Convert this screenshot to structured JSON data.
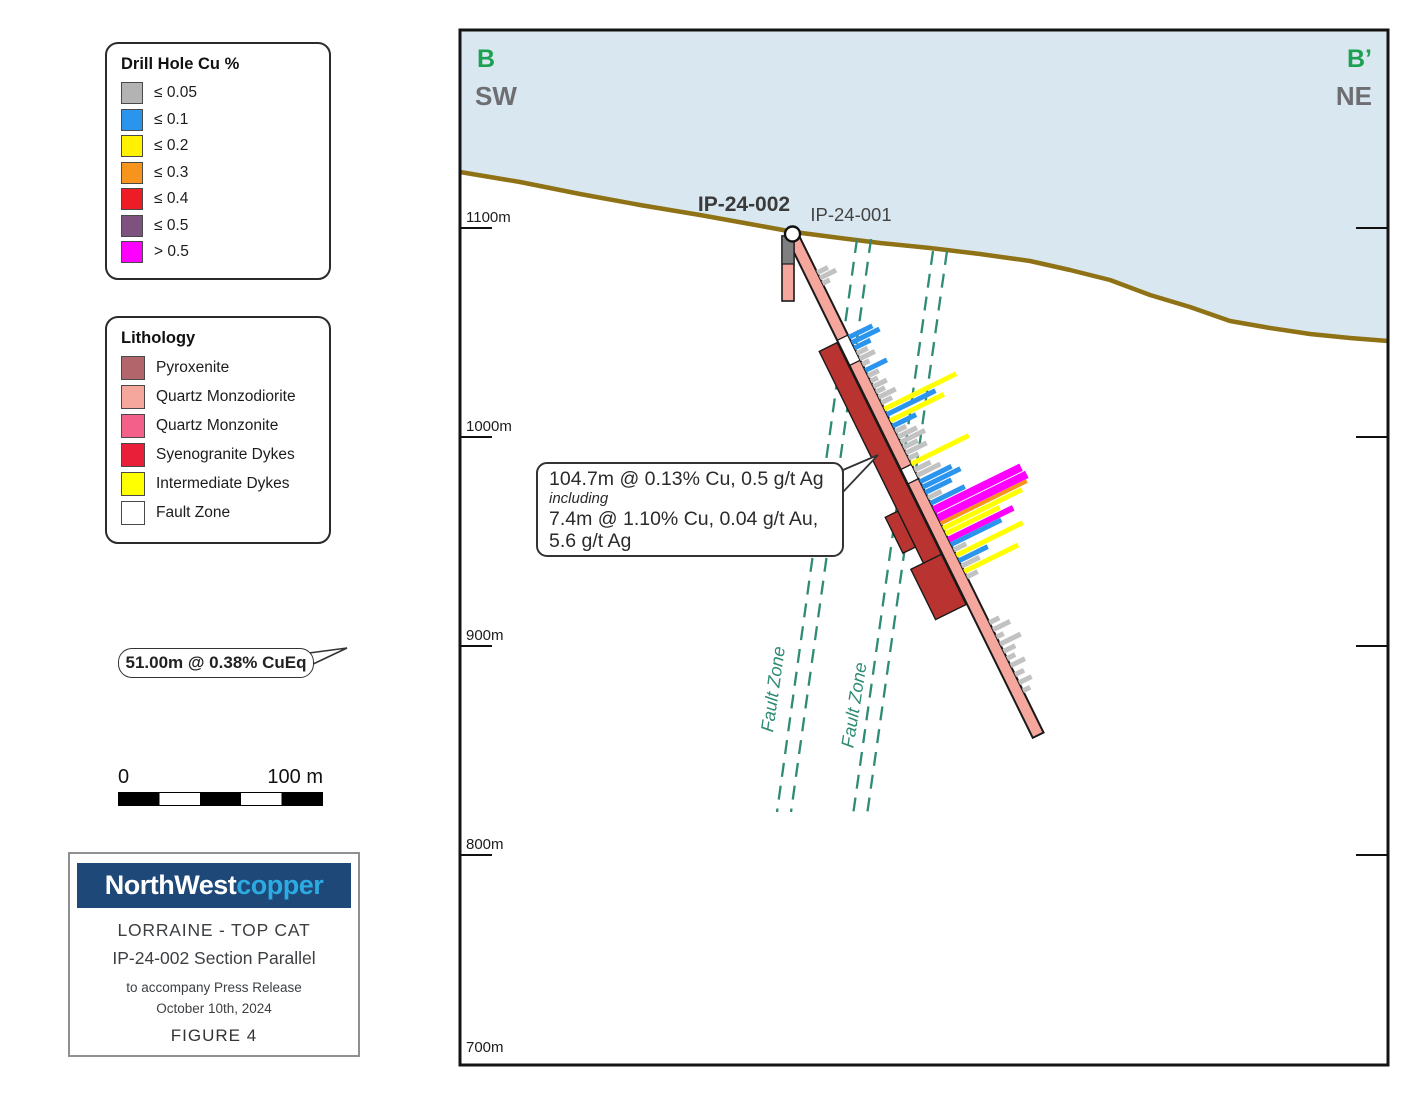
{
  "colors": {
    "sky": "#d9e8f0",
    "topo": "#8f7215",
    "teal": "#2e8b74",
    "green": "#1ca152",
    "corner_gray": "#6d6e71",
    "salmon": "#f5a79e",
    "band_red": "#b93431",
    "hole_gray": "#7f7f7f",
    "navy": "#1d4877",
    "copper_blue": "#2caae1",
    "bar_gray": "#c2c2c2",
    "bar_blue": "#2b95ee",
    "bar_yellow": "#ffff00",
    "bar_orange": "#f7941d",
    "bar_magenta": "#ff00ff"
  },
  "cu_legend": {
    "title": "Drill Hole Cu %",
    "items": [
      {
        "label": "≤ 0.05",
        "color": "#b3b3b3"
      },
      {
        "label": "≤ 0.1",
        "color": "#2b95ee"
      },
      {
        "label": "≤ 0.2",
        "color": "#fff200"
      },
      {
        "label": "≤ 0.3",
        "color": "#f7941d"
      },
      {
        "label": "≤ 0.4",
        "color": "#ee1c25"
      },
      {
        "label": "≤ 0.5",
        "color": "#7d527e"
      },
      {
        "label": "> 0.5",
        "color": "#ff00ff"
      }
    ]
  },
  "lithology_legend": {
    "title": "Lithology",
    "items": [
      {
        "label": "Pyroxenite",
        "color": "#b2656a"
      },
      {
        "label": "Quartz Monzodiorite",
        "color": "#f5a79e"
      },
      {
        "label": "Quartz Monzonite",
        "color": "#f3608a"
      },
      {
        "label": "Syenogranite Dykes",
        "color": "#e91f3a"
      },
      {
        "label": "Intermediate Dykes",
        "color": "#ffff00"
      },
      {
        "label": "Fault Zone",
        "color": "#ffffff"
      }
    ]
  },
  "sample_callout": {
    "text": "51.00m @ 0.38% CuEq"
  },
  "scalebar": {
    "start": "0",
    "end": "100 m"
  },
  "title_block": {
    "brand_left": "NorthWest",
    "brand_right": "copper",
    "project": "LORRAINE - TOP CAT",
    "section": "IP-24-002 Section Parallel",
    "note1": "to accompany Press Release",
    "note2": "October 10th, 2024",
    "figure": "FIGURE 4"
  },
  "section": {
    "corner_tl_letter": "B",
    "corner_tl_dir": "SW",
    "corner_tr_letter": "B’",
    "corner_tr_dir": "NE",
    "hole_label_bold": "IP-24-002",
    "hole_label": "IP-24-001",
    "fault_label": "Fault Zone",
    "annotation": {
      "line1": "104.7m @ 0.13% Cu, 0.5 g/t Ag",
      "line2": "including",
      "line3": "7.4m @ 1.10% Cu, 0.04 g/t Au,",
      "line4": "5.6 g/t Ag"
    },
    "elevations": [
      {
        "label": "1100m",
        "tick_y": 228,
        "label_y": 222
      },
      {
        "label": "1000m",
        "tick_y": 437,
        "label_y": 431
      },
      {
        "label": "900m",
        "tick_y": 646,
        "label_y": 640
      },
      {
        "label": "800m",
        "tick_y": 855,
        "label_y": 849
      },
      {
        "label": "700m",
        "tick_y": null,
        "label_y": 1052
      }
    ],
    "topo": [
      [
        460,
        172
      ],
      [
        520,
        182
      ],
      [
        580,
        194
      ],
      [
        640,
        205
      ],
      [
        700,
        215
      ],
      [
        750,
        224
      ],
      [
        794,
        232
      ],
      [
        840,
        238
      ],
      [
        880,
        243
      ],
      [
        930,
        248
      ],
      [
        980,
        254
      ],
      [
        1030,
        261
      ],
      [
        1070,
        270
      ],
      [
        1110,
        280
      ],
      [
        1150,
        295
      ],
      [
        1190,
        307
      ],
      [
        1230,
        321
      ],
      [
        1270,
        328
      ],
      [
        1310,
        334
      ],
      [
        1350,
        338
      ],
      [
        1388,
        341
      ]
    ],
    "faults": [
      {
        "x_top": 857,
        "y_top": 239,
        "x_bot": 777,
        "y_bot": 812,
        "gap": 14,
        "label_x": 779,
        "label_y": 690,
        "rot": -82
      },
      {
        "x_top": 933,
        "y_top": 251,
        "x_bot": 853,
        "y_bot": 815,
        "gap": 14,
        "label_x": 860,
        "label_y": 706,
        "rot": -81
      }
    ],
    "vertical_hole": {
      "x": 782,
      "y": 236,
      "w": 12,
      "h": 65,
      "gray_h": 28
    },
    "collar": {
      "cx": 792.5,
      "cy": 234,
      "r": 7.5
    },
    "hole": {
      "x": 794,
      "y": 239,
      "angle": 63.8,
      "length": 553,
      "width": 12,
      "white_segs": [
        [
          110,
          28
        ],
        [
          254,
          16
        ]
      ],
      "band": {
        "x1": 112,
        "x2": 378,
        "off": 7,
        "w": 20
      },
      "bumps": [
        [
          290,
          330,
          27,
          41
        ],
        [
          348,
          404,
          7,
          41
        ]
      ],
      "bars": [
        [
          38,
          12,
          "g"
        ],
        [
          44,
          18,
          "g"
        ],
        [
          50,
          8,
          "g"
        ],
        [
          110,
          26,
          "b"
        ],
        [
          116,
          31,
          "b"
        ],
        [
          122,
          18,
          "b"
        ],
        [
          128,
          12,
          "g"
        ],
        [
          134,
          17,
          "g"
        ],
        [
          140,
          8,
          "g"
        ],
        [
          147,
          24,
          "b"
        ],
        [
          153,
          12,
          "g"
        ],
        [
          159,
          8,
          "g"
        ],
        [
          165,
          15,
          "g"
        ],
        [
          171,
          10,
          "g"
        ],
        [
          177,
          19,
          "g"
        ],
        [
          183,
          12,
          "g"
        ],
        [
          190,
          80,
          "y"
        ],
        [
          196,
          54,
          "b"
        ],
        [
          203,
          60,
          "y"
        ],
        [
          209,
          26,
          "b"
        ],
        [
          215,
          12,
          "g"
        ],
        [
          221,
          21,
          "g"
        ],
        [
          227,
          27,
          "g"
        ],
        [
          233,
          16,
          "g"
        ],
        [
          239,
          23,
          "g"
        ],
        [
          245,
          11,
          "g"
        ],
        [
          251,
          64,
          "y"
        ],
        [
          258,
          18,
          "g"
        ],
        [
          264,
          26,
          "g"
        ],
        [
          271,
          35,
          "b"
        ],
        [
          277,
          42,
          "b"
        ],
        [
          283,
          29,
          "b"
        ],
        [
          289,
          15,
          "g"
        ],
        [
          295,
          38,
          "b"
        ],
        [
          301,
          97,
          "m",
          8
        ],
        [
          310,
          99,
          "m",
          8
        ],
        [
          318,
          96,
          "o",
          4
        ],
        [
          323,
          88,
          "y"
        ],
        [
          329,
          60,
          "y"
        ],
        [
          335,
          72,
          "m",
          6
        ],
        [
          341,
          56,
          "b"
        ],
        [
          347,
          14,
          "g"
        ],
        [
          353,
          74,
          "y"
        ],
        [
          359,
          32,
          "b"
        ],
        [
          365,
          20,
          "g"
        ],
        [
          371,
          60,
          "y"
        ],
        [
          377,
          12,
          "g"
        ],
        [
          428,
          11,
          "g"
        ],
        [
          436,
          19,
          "g"
        ],
        [
          444,
          8,
          "g"
        ],
        [
          452,
          23,
          "g"
        ],
        [
          460,
          13,
          "g"
        ],
        [
          468,
          9,
          "g"
        ],
        [
          476,
          16,
          "g"
        ],
        [
          486,
          10,
          "g"
        ],
        [
          495,
          14,
          "g"
        ],
        [
          504,
          8,
          "g"
        ]
      ]
    }
  }
}
